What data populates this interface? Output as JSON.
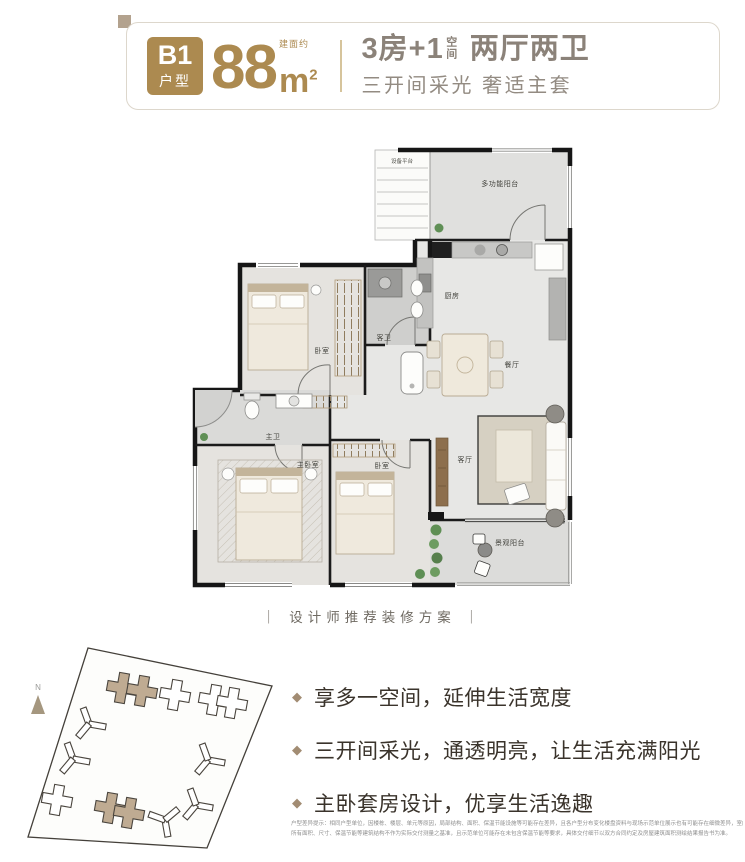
{
  "header": {
    "badge": {
      "line1": "B1",
      "line2": "户型"
    },
    "area": {
      "note": "建面约",
      "value": "88",
      "unit": "m",
      "sup": "2"
    },
    "headline": {
      "part1": "3房+1",
      "stacked": "空间",
      "part2": "两厅两卫"
    },
    "subheadline": "三开间采光 奢适主套"
  },
  "floorplan": {
    "rooms": {
      "equipment_platform": "设备平台",
      "multi_balcony": "多功能阳台",
      "kitchen": "厨房",
      "dining": "餐厅",
      "guest_bath": "客卫",
      "bedroom_top": "卧室",
      "master_bath": "主卫",
      "master_bedroom": "主卧室",
      "bedroom_second": "卧室",
      "living": "客厅",
      "view_balcony": "景观阳台"
    }
  },
  "caption": "｜ 设计师推荐装修方案 ｜",
  "siteplan": {
    "north": "N"
  },
  "features": [
    {
      "text": "享多一空间，延伸生活宽度"
    },
    {
      "text": "三开间采光，通透明亮，让生活充满阳光"
    },
    {
      "text": "主卧套房设计，优享生活逸趣"
    }
  ],
  "disclaimer": {
    "line1": "户型差异提示：相同户型单位，因楼栋、楼层、单元等原因，局部结构、面积、保温节能设施等可能存在差异，且各户型分布变化楼盘资料与现场示范单位展示也有可能存在细微差异，室内外",
    "line2": "所有面积、尺寸、保温节能等建筑结构不作为实际交付测量之基准，且示范单位可能存在未包含保温节能等要求，具体交付细节以双方合同约定及房屋建筑面积测绘结果报告书为准。"
  },
  "colors": {
    "gold": "#ac8a50",
    "header_text": "#8b8279",
    "wall": "#1a1a1a",
    "floor": "#e4e4e2",
    "highlight_tan": "#bfab92",
    "bullet": "#a28c73"
  }
}
